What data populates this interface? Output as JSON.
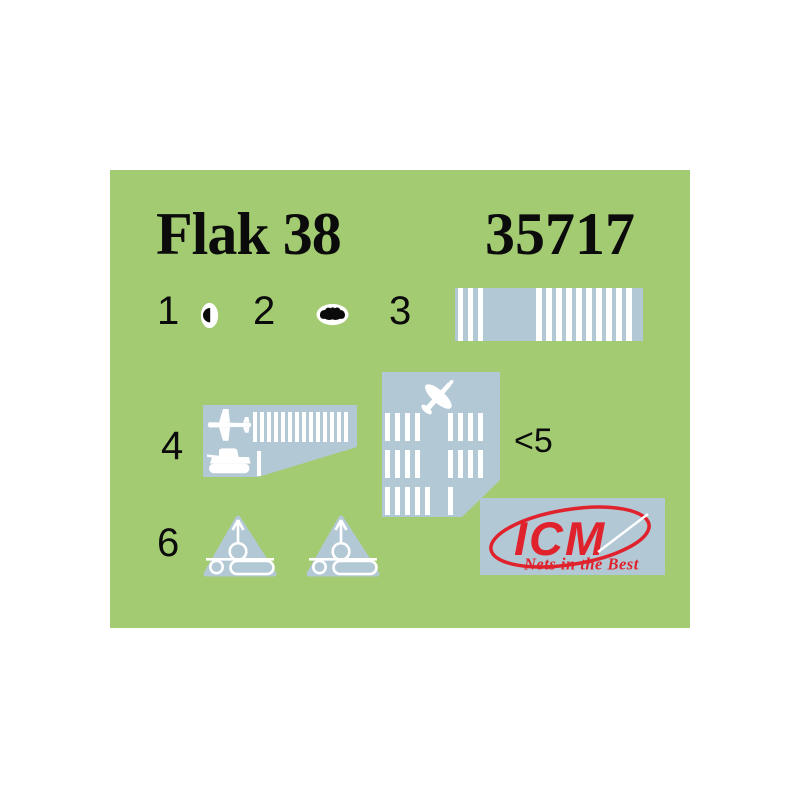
{
  "colors": {
    "page_bg": "#ffffff",
    "sheet_green": "#a3cb72",
    "decal_gray": "#b3c8d5",
    "brand_red": "#e0222d",
    "ink_black": "#0b0b0b",
    "decal_white": "#ffffff"
  },
  "sheet": {
    "title": "Flak 38",
    "kit_number": "35717"
  },
  "items": {
    "item1": {
      "label": "1",
      "decal": "sight-half-dot-decal"
    },
    "item2": {
      "label": "2",
      "decal": "gun-shield-blob-decal"
    },
    "item3": {
      "label": "3",
      "barcode": {
        "left_stripes": 3,
        "right_stripes": 10
      }
    },
    "item4": {
      "label": "4",
      "stripe_groups": [
        5,
        4,
        4,
        1
      ]
    },
    "item5": {
      "label": "<5",
      "stripe_rows": [
        [
          4,
          4
        ],
        [
          4,
          4
        ],
        [
          5,
          1
        ]
      ]
    },
    "item6": {
      "label": "6",
      "marking_count": 2
    }
  },
  "brand": {
    "name": "ICM",
    "slogan": "Nets in the Best"
  }
}
